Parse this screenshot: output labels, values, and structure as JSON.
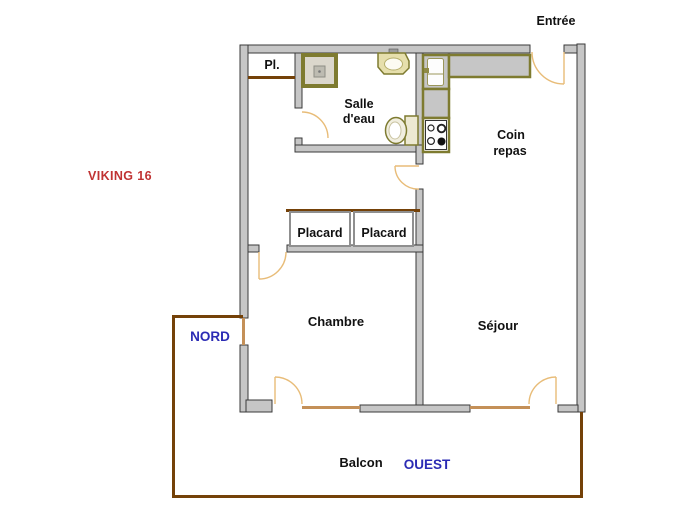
{
  "plan": {
    "title": "VIKING 16",
    "annotations": {
      "entree": "Entrée",
      "nord": "NORD",
      "ouest": "OUEST"
    },
    "rooms": {
      "pl": "Pl.",
      "salle_eau_line1": "Salle",
      "salle_eau_line2": "d'eau",
      "coin_repas_line1": "Coin",
      "coin_repas_line2": "repas",
      "placard_left": "Placard",
      "placard_right": "Placard",
      "chambre": "Chambre",
      "sejour": "Séjour",
      "balcon": "Balcon"
    },
    "fixtures": [
      "shower-icon",
      "washbasin-icon",
      "toilet-icon",
      "kitchen-sink-icon",
      "kitchen-counter-icon",
      "stove-icon"
    ],
    "colors": {
      "background": "#FFFFFF",
      "wall_fill": "#C6C6C6",
      "wall_stroke": "#3A3A3A",
      "balcony_rail": "#744108",
      "door_arc": "#E8BC78",
      "window_marker": "#C49058",
      "fixture_border": "#7E7B30",
      "label_blue": "#2B2BB4",
      "title_red": "#C03333"
    }
  }
}
